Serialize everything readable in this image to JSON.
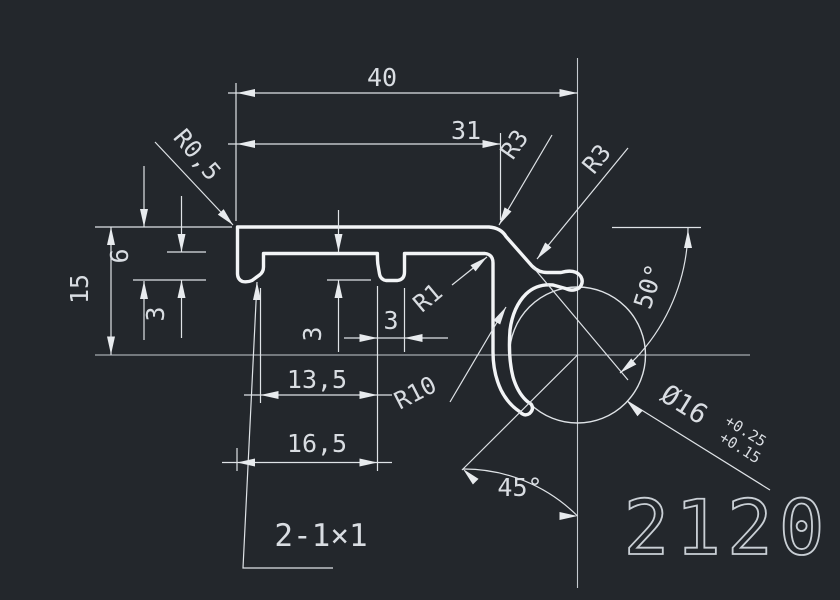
{
  "drawing": {
    "part_number": "2120",
    "chamfer_note": "2-1×1",
    "dims": {
      "total_width": "40",
      "inner_width": "31",
      "total_height": "15",
      "lip_height": "6",
      "lip_depth": "3",
      "rib_depth": "3",
      "rib_width": "3",
      "width_13_5": "13,5",
      "width_16_5": "16,5"
    },
    "radii": {
      "corner_small": "R0,5",
      "corner_top": "R3",
      "hook": "R3",
      "inner_corner": "R1",
      "mouth": "R10"
    },
    "angles": {
      "slope": "50°",
      "opening": "45°"
    },
    "bore": {
      "diameter": "Ø16",
      "tol_upper": "+0.25",
      "tol_lower": "+0.15"
    },
    "colors": {
      "background": "#23272c",
      "profile_line": "#f2f4f6",
      "dimension_line": "#dfe3e7",
      "centerline": "#c6cbd1",
      "text": "#d9dde2"
    }
  }
}
